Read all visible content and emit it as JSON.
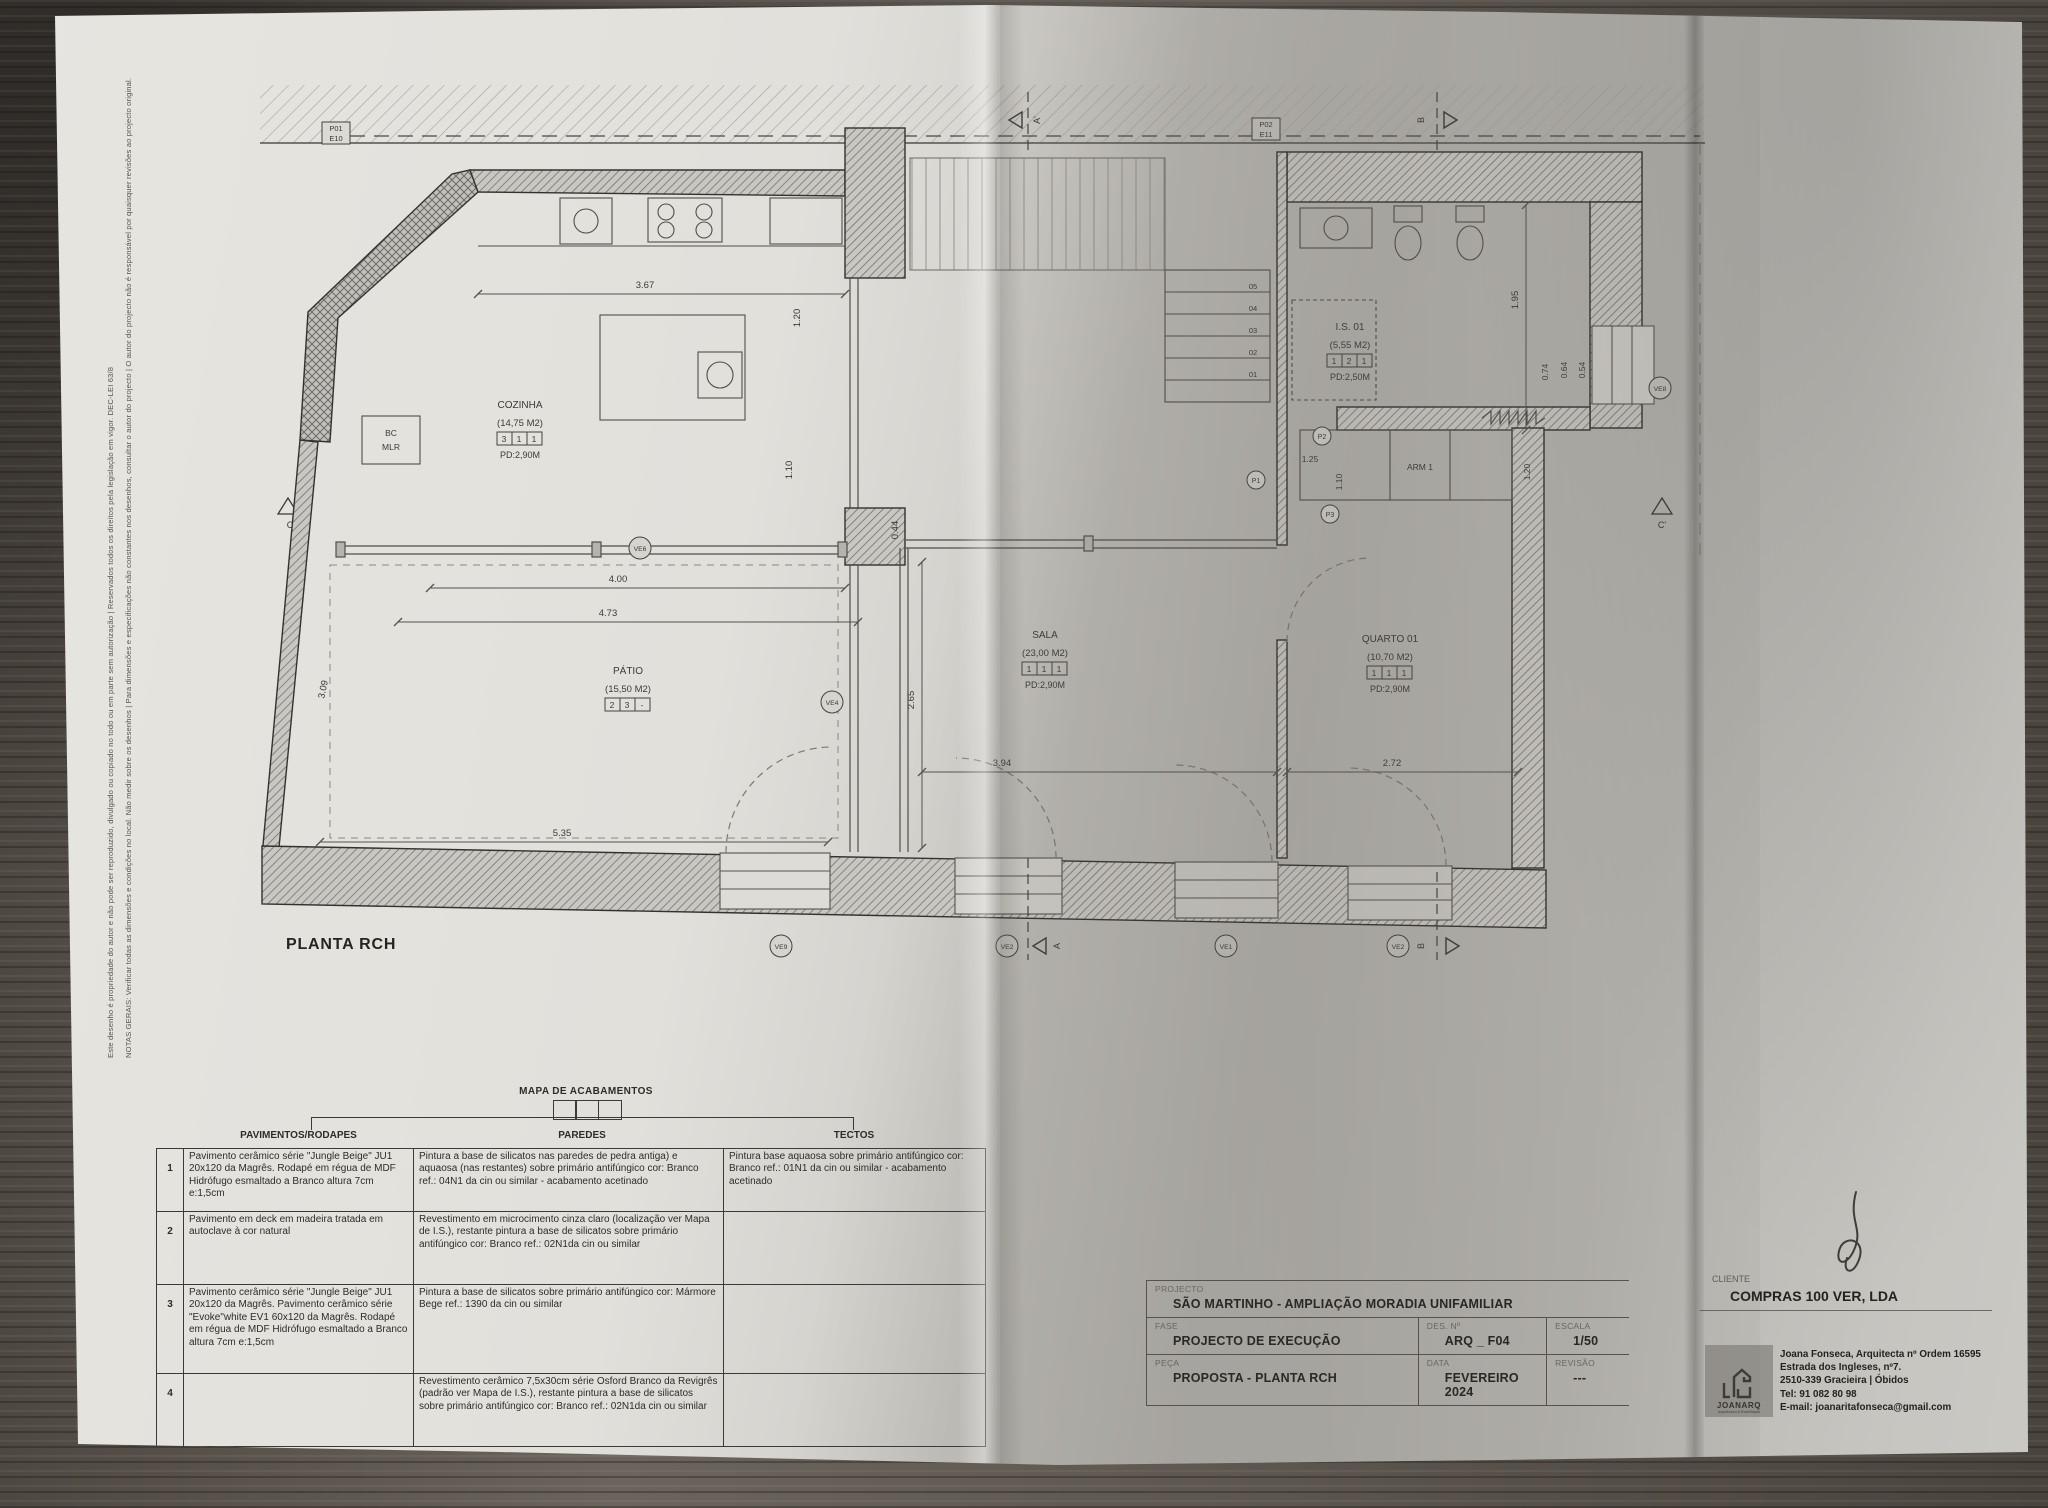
{
  "notes": {
    "line1": "NOTAS GERAIS: Verificar todas as dimensões e condições no local. Não medir sobre os desenhos | Para dimensões e especificações não constantes nos desenhos, consultar o autor do projecto | O autor do projecto não é responsável por quaisquer revisões ao projecto original.",
    "line2": "Este desenho é propriedade do autor e não pode ser reproduzido, divulgado ou copiado no todo ou em parte sem autorização | Reservados todos os direitos pela legislação em vigor. DEC-LEI 63/8"
  },
  "plan": {
    "caption": "PLANTA RCH",
    "tags": {
      "t1a": "P01",
      "t1b": "E10",
      "t2a": "P02",
      "t2b": "E11"
    },
    "sections": {
      "top_a": "A'",
      "top_b": "B",
      "bottom_a": "A",
      "bottom_b": "B",
      "left": "C",
      "right": "C'"
    },
    "rooms": {
      "cozinha": {
        "name": "COZINHA",
        "area": "(14,75  M2)",
        "codes": [
          "3",
          "1",
          "1"
        ],
        "pd": "PD:2,90M"
      },
      "patio": {
        "name": "PÁTIO",
        "area": "(15,50  M2)",
        "codes": [
          "2",
          "3",
          "-"
        ]
      },
      "sala": {
        "name": "SALA",
        "area": "(23,00  M2)",
        "codes": [
          "1",
          "1",
          "1"
        ],
        "pd": "PD:2,90M"
      },
      "quarto": {
        "name": "QUARTO  01",
        "area": "(10,70  M2)",
        "codes": [
          "1",
          "1",
          "1"
        ],
        "pd": "PD:2,90M"
      },
      "is01": {
        "name": "I.S.  01",
        "area": "(5,55  M2)",
        "codes": [
          "1",
          "2",
          "1"
        ],
        "pd": "PD:2,50M"
      },
      "arm": {
        "label": "ARM  1"
      },
      "bc": {
        "line1": "BC",
        "line2": "MLR"
      }
    },
    "stairs": [
      "05",
      "04",
      "03",
      "02",
      "01"
    ],
    "dims": [
      "3.67",
      "1.20",
      "1.10",
      "4.00",
      "4.73",
      "3.09",
      "5.35",
      "2.65",
      "0.44",
      "3.94",
      "2.72",
      "1.95",
      "0.74",
      "0.64",
      "0.54",
      "1.25",
      "1.10",
      "1.20"
    ],
    "markers": [
      "VE6",
      "VE4",
      "VE8",
      "VE9",
      "VE2",
      "VE1",
      "VE2"
    ],
    "p_refs": [
      "P1",
      "P2",
      "P3"
    ]
  },
  "table": {
    "title": "MAPA DE ACABAMENTOS",
    "headers": [
      "PAVIMENTOS/RODAPES",
      "PAREDES",
      "TECTOS"
    ],
    "rows": [
      {
        "num": "1",
        "pavimentos": "Pavimento cerâmico série \"Jungle Beige\" JU1 20x120 da Magrês. Rodapé em régua de MDF Hidrófugo esmaltado a Branco altura 7cm e:1,5cm",
        "paredes": "Pintura a base de silicatos nas paredes de pedra antiga) e aquaosa (nas restantes) sobre primário antifúngico cor: Branco ref.: 04N1 da cin ou similar - acabamento acetinado",
        "tectos": "Pintura base aquaosa sobre primário antifúngico cor: Branco ref.: 01N1 da cin ou similar - acabamento acetinado"
      },
      {
        "num": "2",
        "pavimentos": "Pavimento em deck em madeira tratada em autoclave à cor natural",
        "paredes": "Revestimento em microcimento cinza claro (localização ver Mapa de I.S.), restante pintura a base de silicatos sobre primário antifúngico cor: Branco ref.: 02N1da cin ou similar",
        "tectos": ""
      },
      {
        "num": "3",
        "pavimentos": "Pavimento cerâmico série \"Jungle Beige\" JU1 20x120 da Magrês. Pavimento cerâmico série \"Evoke\"white EV1 60x120 da Magrês. Rodapé em régua de MDF Hidrófugo esmaltado a Branco altura 7cm e:1,5cm",
        "paredes": "Pintura a base de silicatos sobre primário antifúngico cor: Mármore Bege ref.: 1390 da cin ou similar",
        "tectos": ""
      },
      {
        "num": "4",
        "pavimentos": "",
        "paredes": "Revestimento cerâmico 7,5x30cm série Osford Branco da Revigrês (padrão ver Mapa de I.S.), restante pintura a base de silicatos sobre primário antifúngico cor: Branco ref.: 02N1da cin ou similar",
        "tectos": ""
      }
    ]
  },
  "titleblock": {
    "projecto_label": "PROJECTO",
    "projecto": "SÃO MARTINHO  -  AMPLIAÇÃO  MORADIA UNIFAMILIAR",
    "fase_label": "FASE",
    "fase": "PROJECTO DE EXECUÇÃO",
    "peca_label": "PEÇA",
    "peca": "PROPOSTA - PLANTA RCH",
    "des_label": "DES. Nº",
    "des": "ARQ _ F04",
    "data_label": "DATA",
    "data": "FEVEREIRO 2024",
    "escala_label": "ESCALA",
    "escala": "1/50",
    "revisao_label": "REVISÃO",
    "revisao": "---"
  },
  "client": {
    "label": "CLIENTE",
    "name": "COMPRAS 100 VER, LDA"
  },
  "firm": {
    "logo": "JOANARQ",
    "logo_sub": "Arquitectura & Reabilitação",
    "lines": [
      "Joana Fonseca, Arquitecta nº Ordem 16595",
      "Estrada dos Ingleses, nº7.",
      "2510-339 Gracieira | Óbidos",
      "Tel: 91 082 80 98",
      "E-mail: joanaritafonseca@gmail.com"
    ]
  }
}
